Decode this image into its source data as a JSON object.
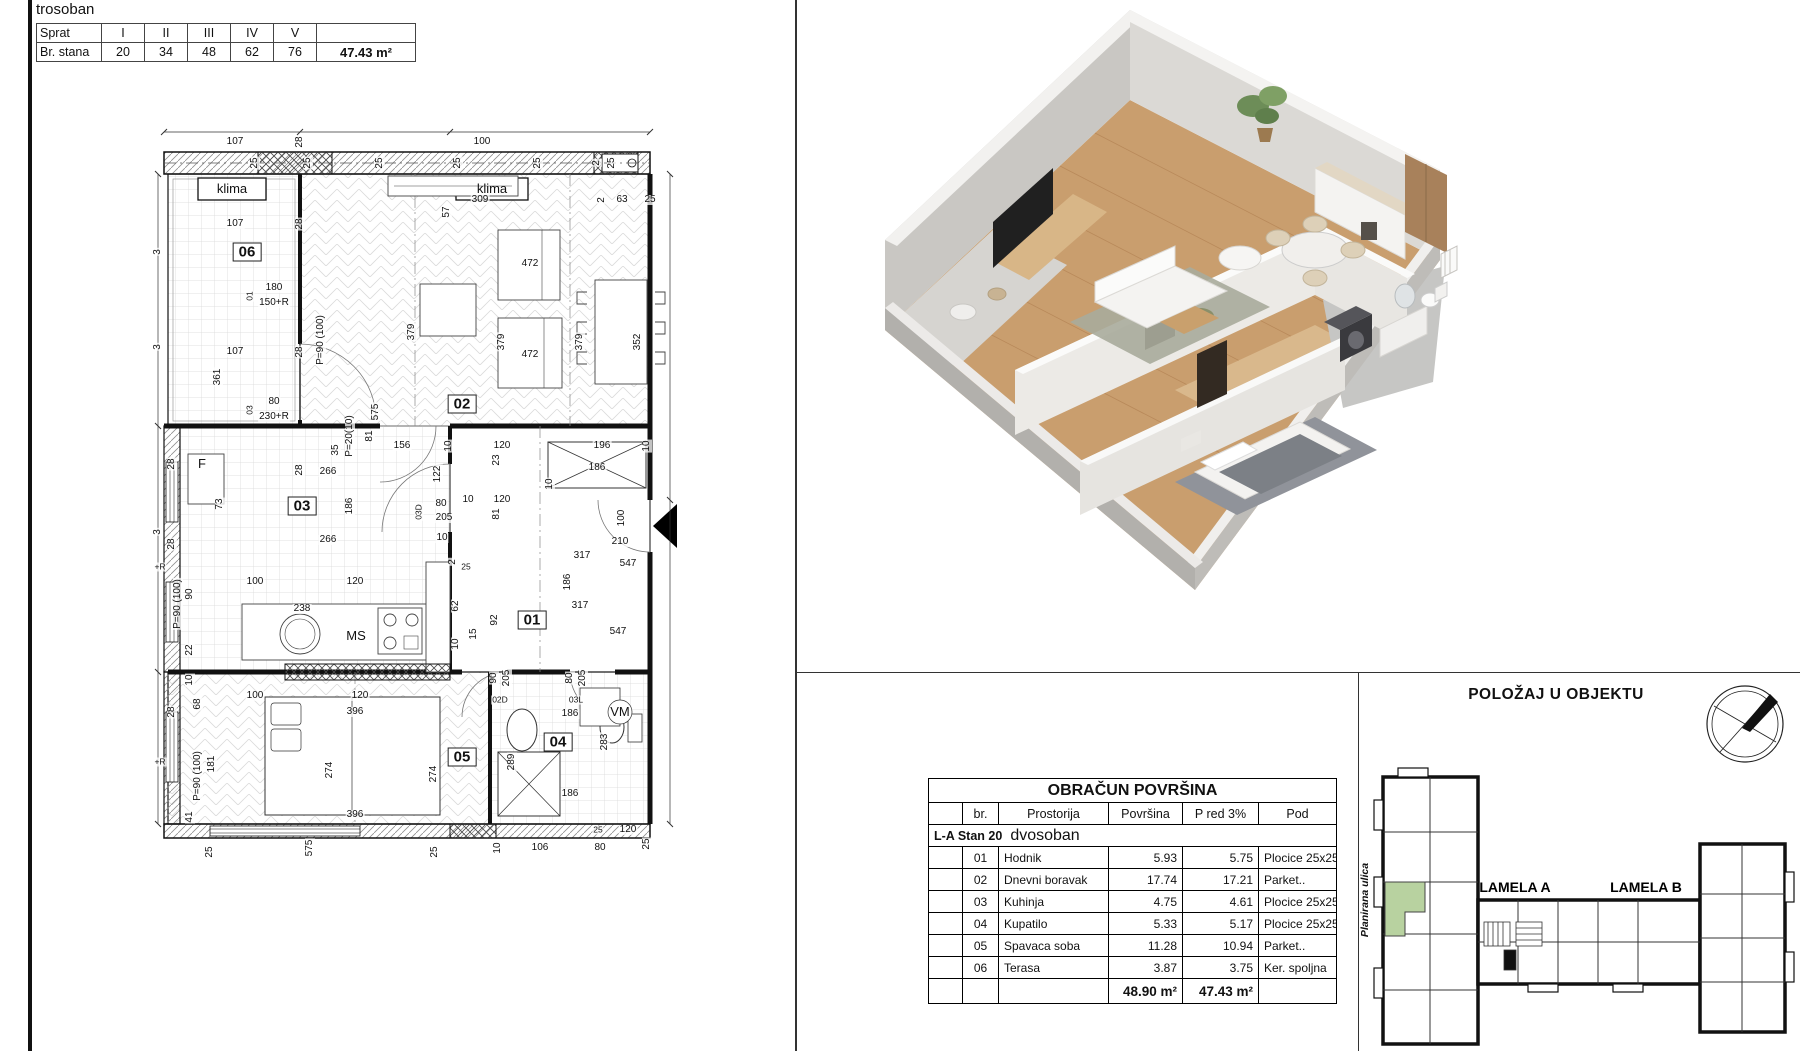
{
  "header": {
    "title": "trosoban",
    "floors_table": {
      "row1_label": "Sprat",
      "row2_label": "Br. stana",
      "floors": [
        "I",
        "II",
        "III",
        "IV",
        "V"
      ],
      "units": [
        "20",
        "34",
        "48",
        "62",
        "76"
      ],
      "area": "47.43 m²"
    }
  },
  "floorplan": {
    "labels": [
      {
        "t": "klima",
        "x": 82,
        "y": 77,
        "c": "tagbox"
      },
      {
        "t": "klima",
        "x": 342,
        "y": 77,
        "c": "tagbox"
      },
      {
        "t": "25",
        "x": 105,
        "y": 51,
        "r": 1
      },
      {
        "t": "25",
        "x": 158,
        "y": 51,
        "r": 1
      },
      {
        "t": "25",
        "x": 230,
        "y": 51,
        "r": 1
      },
      {
        "t": "25",
        "x": 308,
        "y": 51,
        "r": 1
      },
      {
        "t": "25",
        "x": 388,
        "y": 51,
        "r": 1
      },
      {
        "t": "2",
        "x": 447,
        "y": 51,
        "r": 1
      },
      {
        "t": "25",
        "x": 462,
        "y": 51,
        "r": 1
      },
      {
        "t": "107",
        "x": 85,
        "y": 30
      },
      {
        "t": "28",
        "x": 150,
        "y": 30,
        "r": 1
      },
      {
        "t": "57",
        "x": 297,
        "y": 100,
        "r": 1
      },
      {
        "t": "100",
        "x": 332,
        "y": 30
      },
      {
        "t": "309",
        "x": 330,
        "y": 88
      },
      {
        "t": "2",
        "x": 452,
        "y": 88,
        "r": 1
      },
      {
        "t": "63",
        "x": 472,
        "y": 88
      },
      {
        "t": "25",
        "x": 500,
        "y": 88
      },
      {
        "t": "3",
        "x": 8,
        "y": 140,
        "r": 1
      },
      {
        "t": "3",
        "x": 8,
        "y": 235,
        "r": 1
      },
      {
        "t": "3",
        "x": 8,
        "y": 420,
        "r": 1
      },
      {
        "t": "06",
        "x": 97,
        "y": 140,
        "c": "room"
      },
      {
        "t": "107",
        "x": 85,
        "y": 112
      },
      {
        "t": "107",
        "x": 85,
        "y": 240
      },
      {
        "t": "361",
        "x": 68,
        "y": 265,
        "r": 1
      },
      {
        "t": "180",
        "x": 124,
        "y": 176
      },
      {
        "t": "150+R",
        "x": 124,
        "y": 191
      },
      {
        "t": "01",
        "x": 100,
        "y": 184,
        "r": 1,
        "c": "sm"
      },
      {
        "t": "80",
        "x": 124,
        "y": 290
      },
      {
        "t": "230+R",
        "x": 124,
        "y": 305
      },
      {
        "t": "03",
        "x": 100,
        "y": 298,
        "r": 1,
        "c": "sm"
      },
      {
        "t": "28",
        "x": 150,
        "y": 112,
        "r": 1
      },
      {
        "t": "28",
        "x": 150,
        "y": 240,
        "r": 1
      },
      {
        "t": "28",
        "x": 150,
        "y": 358,
        "r": 1
      },
      {
        "t": "P=90 (100)",
        "x": 171,
        "y": 228,
        "r": 1
      },
      {
        "t": "472",
        "x": 380,
        "y": 152
      },
      {
        "t": "472",
        "x": 380,
        "y": 243
      },
      {
        "t": "379",
        "x": 262,
        "y": 220,
        "r": 1
      },
      {
        "t": "379",
        "x": 352,
        "y": 230,
        "r": 1
      },
      {
        "t": "379",
        "x": 430,
        "y": 230,
        "r": 1
      },
      {
        "t": "352",
        "x": 488,
        "y": 230,
        "r": 1
      },
      {
        "t": "02",
        "x": 312,
        "y": 292,
        "c": "room"
      },
      {
        "t": "575",
        "x": 226,
        "y": 300,
        "r": 1
      },
      {
        "t": "P=20(10)",
        "x": 200,
        "y": 324,
        "r": 1
      },
      {
        "t": "81",
        "x": 220,
        "y": 324,
        "r": 1
      },
      {
        "t": "35",
        "x": 186,
        "y": 338,
        "r": 1
      },
      {
        "t": "156",
        "x": 252,
        "y": 334
      },
      {
        "t": "10",
        "x": 299,
        "y": 334,
        "r": 1
      },
      {
        "t": "120",
        "x": 352,
        "y": 334
      },
      {
        "t": "196",
        "x": 452,
        "y": 334
      },
      {
        "t": "10",
        "x": 497,
        "y": 334,
        "r": 1
      },
      {
        "t": "F",
        "x": 52,
        "y": 352,
        "c": "ms"
      },
      {
        "t": "73",
        "x": 70,
        "y": 392,
        "r": 1
      },
      {
        "t": "266",
        "x": 178,
        "y": 360
      },
      {
        "t": "186",
        "x": 200,
        "y": 394,
        "r": 1
      },
      {
        "t": "03",
        "x": 152,
        "y": 394,
        "c": "room"
      },
      {
        "t": "266",
        "x": 178,
        "y": 428
      },
      {
        "t": "28",
        "x": 22,
        "y": 352,
        "r": 1
      },
      {
        "t": "28",
        "x": 22,
        "y": 432,
        "r": 1
      },
      {
        "t": "122",
        "x": 288,
        "y": 362,
        "r": 1
      },
      {
        "t": "80",
        "x": 291,
        "y": 392
      },
      {
        "t": "205",
        "x": 294,
        "y": 406
      },
      {
        "t": "03D",
        "x": 269,
        "y": 400,
        "r": 1,
        "c": "sm"
      },
      {
        "t": "10",
        "x": 292,
        "y": 426
      },
      {
        "t": "23",
        "x": 347,
        "y": 348,
        "r": 1
      },
      {
        "t": "81",
        "x": 347,
        "y": 402,
        "r": 1
      },
      {
        "t": "10",
        "x": 318,
        "y": 388
      },
      {
        "t": "120",
        "x": 352,
        "y": 388
      },
      {
        "t": "10",
        "x": 400,
        "y": 372,
        "r": 1
      },
      {
        "t": "186",
        "x": 447,
        "y": 356
      },
      {
        "t": "100",
        "x": 105,
        "y": 470
      },
      {
        "t": "120",
        "x": 205,
        "y": 470
      },
      {
        "t": "238",
        "x": 152,
        "y": 497
      },
      {
        "t": "MS",
        "x": 206,
        "y": 524,
        "c": "ms"
      },
      {
        "t": "90",
        "x": 40,
        "y": 482,
        "r": 1
      },
      {
        "t": "P=90 (100)",
        "x": 28,
        "y": 492,
        "r": 1
      },
      {
        "t": "+R",
        "x": 10,
        "y": 455,
        "c": "sm"
      },
      {
        "t": "22",
        "x": 40,
        "y": 538,
        "r": 1
      },
      {
        "t": "2",
        "x": 303,
        "y": 450,
        "r": 1
      },
      {
        "t": "25",
        "x": 316,
        "y": 455,
        "c": "sm"
      },
      {
        "t": "62",
        "x": 306,
        "y": 494,
        "r": 1
      },
      {
        "t": "10",
        "x": 306,
        "y": 532,
        "r": 1
      },
      {
        "t": "15",
        "x": 324,
        "y": 522,
        "r": 1
      },
      {
        "t": "92",
        "x": 345,
        "y": 508,
        "r": 1
      },
      {
        "t": "01",
        "x": 382,
        "y": 508,
        "c": "room"
      },
      {
        "t": "317",
        "x": 432,
        "y": 444
      },
      {
        "t": "186",
        "x": 418,
        "y": 470,
        "r": 1
      },
      {
        "t": "547",
        "x": 478,
        "y": 452
      },
      {
        "t": "317",
        "x": 430,
        "y": 494
      },
      {
        "t": "547",
        "x": 468,
        "y": 520
      },
      {
        "t": "100",
        "x": 472,
        "y": 406,
        "r": 1
      },
      {
        "t": "210",
        "x": 470,
        "y": 430
      },
      {
        "t": "10",
        "x": 40,
        "y": 568,
        "r": 1
      },
      {
        "t": "68",
        "x": 48,
        "y": 592,
        "r": 1
      },
      {
        "t": "100",
        "x": 105,
        "y": 584
      },
      {
        "t": "120",
        "x": 210,
        "y": 584
      },
      {
        "t": "90",
        "x": 344,
        "y": 566,
        "r": 1
      },
      {
        "t": "205",
        "x": 357,
        "y": 566,
        "r": 1
      },
      {
        "t": "02D",
        "x": 350,
        "y": 588,
        "c": "sm"
      },
      {
        "t": "80",
        "x": 420,
        "y": 566,
        "r": 1
      },
      {
        "t": "205",
        "x": 433,
        "y": 566,
        "r": 1
      },
      {
        "t": "03L",
        "x": 426,
        "y": 588,
        "c": "sm"
      },
      {
        "t": "28",
        "x": 22,
        "y": 600,
        "r": 1
      },
      {
        "t": "181",
        "x": 62,
        "y": 652,
        "r": 1
      },
      {
        "t": "P=90 (100)",
        "x": 48,
        "y": 664,
        "r": 1
      },
      {
        "t": "+R",
        "x": 10,
        "y": 650,
        "c": "sm"
      },
      {
        "t": "41",
        "x": 40,
        "y": 705,
        "r": 1
      },
      {
        "t": "396",
        "x": 205,
        "y": 600
      },
      {
        "t": "274",
        "x": 180,
        "y": 658,
        "r": 1
      },
      {
        "t": "274",
        "x": 284,
        "y": 662,
        "r": 1
      },
      {
        "t": "05",
        "x": 312,
        "y": 645,
        "c": "room"
      },
      {
        "t": "396",
        "x": 205,
        "y": 703
      },
      {
        "t": "186",
        "x": 420,
        "y": 602
      },
      {
        "t": "04",
        "x": 408,
        "y": 630,
        "c": "room"
      },
      {
        "t": "283",
        "x": 455,
        "y": 630,
        "r": 1
      },
      {
        "t": "289",
        "x": 362,
        "y": 650,
        "r": 1
      },
      {
        "t": "VM",
        "x": 470,
        "y": 600,
        "c": "ms"
      },
      {
        "t": "186",
        "x": 420,
        "y": 682
      },
      {
        "t": "10",
        "x": 348,
        "y": 736,
        "r": 1
      },
      {
        "t": "106",
        "x": 390,
        "y": 736
      },
      {
        "t": "80",
        "x": 450,
        "y": 736
      },
      {
        "t": "25",
        "x": 497,
        "y": 732,
        "r": 1
      },
      {
        "t": "25",
        "x": 448,
        "y": 718,
        "c": "sm"
      },
      {
        "t": "120",
        "x": 478,
        "y": 718
      },
      {
        "t": "25",
        "x": 60,
        "y": 740,
        "r": 1
      },
      {
        "t": "575",
        "x": 160,
        "y": 736,
        "r": 1
      },
      {
        "t": "25",
        "x": 285,
        "y": 740,
        "r": 1
      }
    ]
  },
  "area_table": {
    "title": "OBRAČUN POVRŠINA",
    "columns": [
      "br.",
      "Prostorija",
      "Površina",
      "P red 3%",
      "Pod"
    ],
    "group": "L-A Stan 20",
    "group_type": "dvosoban",
    "rows": [
      [
        "01",
        "Hodnik",
        "5.93",
        "5.75",
        "Plocice 25x25"
      ],
      [
        "02",
        "Dnevni boravak",
        "17.74",
        "17.21",
        "Parket.."
      ],
      [
        "03",
        "Kuhinja",
        "4.75",
        "4.61",
        "Plocice 25x25"
      ],
      [
        "04",
        "Kupatilo",
        "5.33",
        "5.17",
        "Plocice 25x25"
      ],
      [
        "05",
        "Spavaca soba",
        "11.28",
        "10.94",
        "Parket.."
      ],
      [
        "06",
        "Terasa",
        "3.87",
        "3.75",
        "Ker. spoljna"
      ]
    ],
    "total_povrsina": "48.90 m²",
    "total_pred": "47.43 m²"
  },
  "position": {
    "title": "POLOŽAJ U OBJEKTU",
    "lamela_a": "LAMELA A",
    "lamela_b": "LAMELA B",
    "street_left": "Planirana ulica",
    "street_right": "Ulica Laze Lazarevića",
    "highlight_color": "#b8d2a0"
  },
  "colors": {
    "wall_gray": "#d2d0cc",
    "floor_wood": "#c99e6e",
    "accent_green": "#b8d2a0"
  }
}
